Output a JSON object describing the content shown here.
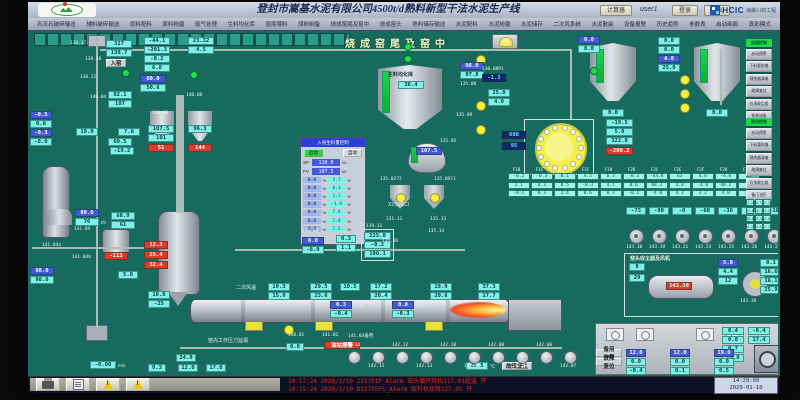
{
  "titlebar": {
    "title": "登封市嵩基水泥有限公司4500t/d熟料新型干法水泥生产线",
    "calc": "计算器",
    "user": "user1",
    "login": "登录",
    "logout": "退出",
    "logo_text": "HCIC",
    "logo_name": "海螺川崎工程"
  },
  "menu": {
    "items": [
      "石灰石破碎输送",
      "辅料破碎输送",
      "原料配料",
      "原料粉磨",
      "废气处理",
      "生料均化库",
      "窑尾喂料",
      "煤粉制备",
      "烧成窑尾及窑中",
      "烧成窑头",
      "熟料储存输送",
      "水泥配料",
      "水泥粉磨",
      "水泥储存",
      "二次风系统",
      "水泥散装",
      "设备报警",
      "历史趋势",
      "参数表",
      "启动画面",
      "真彩模式"
    ]
  },
  "screen_title": {
    "text": "烧成窑尾及窑中"
  },
  "statusbar": {
    "alarms": [
      "10:17:24 2020/1/10 231701P_Alarm 窑头循环风机117.01超温  开",
      "10:15:24 2020/1/10 B12705P1_Alarm 取料机故障127.05  开"
    ],
    "time": "14:29:09",
    "date": "2020-01-10"
  },
  "feed_panel": {
    "title": "入窑生料量控制",
    "btn_start": "启动",
    "btn_auto": "自动",
    "sp_label": "SP",
    "sp": "110.0",
    "sp_unit": "t/h",
    "pv_label": "PV",
    "pv": "107.5",
    "pv_unit": "t/h",
    "unit": "%",
    "rows": [
      {
        "a": "0.0",
        "b": "3.7"
      },
      {
        "a": "0.0",
        "b": "0.3"
      },
      {
        "a": "0.0",
        "b": "1.1"
      },
      {
        "a": "0.0",
        "b": "-1.9"
      },
      {
        "a": "0.0",
        "b": "7.6"
      },
      {
        "a": "0.0",
        "b": "2.0"
      },
      {
        "a": "0.0",
        "b": "2.5"
      }
    ]
  },
  "homo_silo": {
    "label": "生料均化库",
    "value": "36.4"
  },
  "dome_value": "107.5",
  "cooler_section": {
    "title": "窑头收尘器及风机",
    "tank_tag": "143.30"
  },
  "right_groups": [
    {
      "header": "远程控制",
      "buttons": [
        "启动预警",
        "下料管吹堵",
        "预热器清堵",
        "故障复位",
        "仓顶收尘组",
        "伴热油泵"
      ]
    },
    {
      "header": "现场控制",
      "buttons": [
        "启动预警",
        "下料管吹堵",
        "预热器清堵",
        "故障复位",
        "仓顶收尘组",
        "备用油泵"
      ]
    }
  ],
  "right_table": {
    "headers": [
      "F1",
      "F2",
      "F3"
    ],
    "rows": [
      [
        "7.2",
        "0.7",
        "2.2"
      ],
      [
        "17.8",
        "16.7",
        "4.2"
      ],
      [
        "16.0",
        "14.0",
        "4.0"
      ],
      [
        "4.2",
        "4.0",
        "1.2"
      ]
    ]
  },
  "grid_table": {
    "x": 478,
    "y": 142,
    "cw": 23,
    "headers": [
      "F1B",
      "F1C",
      "F1E",
      "F1F",
      "F1H",
      "F2B",
      "F2C",
      "F2E",
      "F2F",
      "F2H",
      "F2K"
    ],
    "rows": [
      [
        "-0.2",
        "-0.3",
        "0.1",
        "4.5",
        "6.3",
        "-0.1",
        "-44.8",
        "63",
        "4.0",
        "-4.0",
        "63"
      ],
      [
        "2.1",
        "0.3",
        "0.5",
        "-0.3",
        "4.1",
        "0.6",
        "68.3",
        "4.0",
        "-4.0",
        "40.2",
        "76"
      ],
      [
        "-0.1",
        "0.3",
        "2.4",
        "0.6",
        "0.3",
        "-0.1",
        "-4.0",
        "4.2",
        "3.2",
        "4.0",
        "1.6"
      ]
    ]
  },
  "fans": [
    {
      "v": "-73",
      "t": "143.18"
    },
    {
      "v": "-90",
      "t": "143.19"
    },
    {
      "v": "-0",
      "t": "143.21"
    },
    {
      "v": "-60",
      "t": "143.23"
    },
    {
      "v": "-36",
      "t": "143.25"
    },
    {
      "v": "-48",
      "t": "143.26"
    },
    {
      "v": "-18",
      "t": "143.28"
    }
  ],
  "motors": [
    {
      "t": "142.14",
      "p": "a"
    },
    {
      "t": "142.15",
      "p": "b"
    },
    {
      "t": "142.12",
      "p": "a"
    },
    {
      "t": "142.13",
      "p": "b"
    },
    {
      "t": "142.10",
      "p": "a"
    },
    {
      "t": "142.11",
      "p": "b"
    },
    {
      "t": "142.08",
      "p": "a"
    },
    {
      "t": "142.09",
      "p": "b"
    },
    {
      "t": "142.06",
      "p": "a"
    },
    {
      "t": "142.07",
      "p": "b"
    }
  ],
  "cabinet": {
    "btn1": "备用油泵",
    "btn2": "故障复位",
    "cols": [
      {
        "x": 596,
        "r1": "12.0",
        "r2": "0.0",
        "r3": "-0.4"
      },
      {
        "x": 640,
        "r1": "12.0",
        "r2": "0.0",
        "r3": "0.1"
      },
      {
        "x": 684,
        "r1": "19.0",
        "r2": "0.0",
        "r3": "0.5"
      }
    ]
  },
  "boxes": [
    {
      "x": 76,
      "y": 9,
      "w": 26,
      "t": "317",
      "c": "c"
    },
    {
      "x": 76,
      "y": 18,
      "w": 26,
      "t": "139.7",
      "c": "c"
    },
    {
      "x": 76,
      "y": 28,
      "w": 20,
      "t": "入窑",
      "c": "g"
    },
    {
      "x": 114,
      "y": 6,
      "w": 26,
      "t": "-44.1",
      "c": "c"
    },
    {
      "x": 114,
      "y": 15,
      "w": 26,
      "t": "-201.3",
      "c": "c"
    },
    {
      "x": 114,
      "y": 24,
      "w": 26,
      "t": "-0.2",
      "c": "c"
    },
    {
      "x": 114,
      "y": 33,
      "w": 26,
      "t": "6.8",
      "c": "c"
    },
    {
      "x": 110,
      "y": 44,
      "w": 26,
      "t": "60.0",
      "c": "b"
    },
    {
      "x": 110,
      "y": 53,
      "w": 26,
      "t": "50.6",
      "c": "c"
    },
    {
      "x": 158,
      "y": 6,
      "w": 26,
      "t": "23.32",
      "c": "c"
    },
    {
      "x": 158,
      "y": 15,
      "w": 26,
      "t": "4.5",
      "c": "c"
    },
    {
      "x": 78,
      "y": 60,
      "w": 24,
      "t": "92.1",
      "c": "c"
    },
    {
      "x": 78,
      "y": 69,
      "w": 24,
      "t": "107",
      "c": "c"
    },
    {
      "x": 118,
      "y": 94,
      "w": 26,
      "t": "107.5",
      "c": "c"
    },
    {
      "x": 118,
      "y": 103,
      "w": 26,
      "t": "101",
      "c": "c"
    },
    {
      "x": 118,
      "y": 113,
      "w": 26,
      "t": "51",
      "c": "r"
    },
    {
      "x": 158,
      "y": 94,
      "w": 24,
      "t": "96.3",
      "c": "c"
    },
    {
      "x": 158,
      "y": 113,
      "w": 24,
      "t": "144",
      "c": "r"
    },
    {
      "x": 46,
      "y": 97,
      "w": 22,
      "t": "19.9",
      "c": "c"
    },
    {
      "x": 88,
      "y": 97,
      "w": 22,
      "t": "7.6",
      "c": "c"
    },
    {
      "x": 78,
      "y": 107,
      "w": 24,
      "t": "60.5",
      "c": "c"
    },
    {
      "x": 80,
      "y": 116,
      "w": 24,
      "t": "-19.2",
      "c": "c"
    },
    {
      "x": 0,
      "y": 80,
      "w": 22,
      "t": "-0.5",
      "c": "b"
    },
    {
      "x": 0,
      "y": 89,
      "w": 22,
      "t": "0.6",
      "c": "c"
    },
    {
      "x": 0,
      "y": 98,
      "w": 22,
      "t": "-0.3",
      "c": "b"
    },
    {
      "x": 0,
      "y": 107,
      "w": 22,
      "t": "-0.0",
      "c": "c"
    },
    {
      "x": 45,
      "y": 178,
      "w": 24,
      "t": "80.0",
      "c": "b"
    },
    {
      "x": 45,
      "y": 187,
      "w": 24,
      "t": "76",
      "c": "c",
      "u": "t/h"
    },
    {
      "x": 81,
      "y": 181,
      "w": 24,
      "t": "68.9",
      "c": "c"
    },
    {
      "x": 81,
      "y": 190,
      "w": 24,
      "t": "61",
      "c": "c"
    },
    {
      "x": 74,
      "y": 221,
      "w": 24,
      "t": "-113",
      "c": "r"
    },
    {
      "x": 114,
      "y": 210,
      "w": 24,
      "t": "12.3",
      "c": "r"
    },
    {
      "x": 114,
      "y": 220,
      "w": 24,
      "t": "25.4",
      "c": "r"
    },
    {
      "x": 114,
      "y": 230,
      "w": 24,
      "t": "32.4",
      "c": "r"
    },
    {
      "x": 0,
      "y": 236,
      "w": 24,
      "t": "98.0",
      "c": "b"
    },
    {
      "x": 0,
      "y": 245,
      "w": 24,
      "t": "98.6",
      "c": "c"
    },
    {
      "x": 88,
      "y": 240,
      "w": 20,
      "t": "5.0",
      "c": "c"
    },
    {
      "x": 118,
      "y": 260,
      "w": 22,
      "t": "19.8",
      "c": "c"
    },
    {
      "x": 118,
      "y": 269,
      "w": 22,
      "t": "-25",
      "c": "c"
    },
    {
      "x": 272,
      "y": 206,
      "w": 22,
      "t": "0.0",
      "c": "b"
    },
    {
      "x": 272,
      "y": 215,
      "w": 22,
      "t": "-8.0",
      "c": "c"
    },
    {
      "x": 306,
      "y": 204,
      "w": 20,
      "t": "0.3",
      "c": "c"
    },
    {
      "x": 306,
      "y": 213,
      "w": 20,
      "t": "1.1",
      "c": "c"
    },
    {
      "x": 334,
      "y": 201,
      "w": 27,
      "t": "225.0",
      "c": "c"
    },
    {
      "x": 334,
      "y": 210,
      "w": 27,
      "t": "-0.2",
      "c": "c"
    },
    {
      "x": 334,
      "y": 219,
      "w": 27,
      "t": "100.1",
      "c": "c"
    },
    {
      "x": 238,
      "y": 252,
      "w": 22,
      "t": "19.3",
      "c": "c"
    },
    {
      "x": 238,
      "y": 261,
      "w": 22,
      "t": "15.9",
      "c": "c"
    },
    {
      "x": 280,
      "y": 252,
      "w": 22,
      "t": "29.5",
      "c": "c"
    },
    {
      "x": 280,
      "y": 261,
      "w": 22,
      "t": "23.6",
      "c": "c"
    },
    {
      "x": 310,
      "y": 252,
      "w": 20,
      "t": "10.5",
      "c": "c"
    },
    {
      "x": 340,
      "y": 252,
      "w": 22,
      "t": "17.2",
      "c": "c"
    },
    {
      "x": 340,
      "y": 261,
      "w": 22,
      "t": "20.4",
      "c": "c"
    },
    {
      "x": 400,
      "y": 252,
      "w": 22,
      "t": "19.9",
      "c": "c"
    },
    {
      "x": 400,
      "y": 261,
      "w": 22,
      "t": "20.6",
      "c": "c"
    },
    {
      "x": 448,
      "y": 252,
      "w": 22,
      "t": "37.3",
      "c": "c"
    },
    {
      "x": 448,
      "y": 261,
      "w": 22,
      "t": "17.7",
      "c": "c"
    },
    {
      "x": 300,
      "y": 270,
      "w": 22,
      "t": "0.3",
      "c": "b",
      "u": "门限"
    },
    {
      "x": 300,
      "y": 279,
      "w": 22,
      "t": "-0.4",
      "c": "c"
    },
    {
      "x": 362,
      "y": 270,
      "w": 22,
      "t": "0.8",
      "c": "b",
      "u": "门限"
    },
    {
      "x": 362,
      "y": 279,
      "w": 22,
      "t": "-0.3",
      "c": "c"
    },
    {
      "x": 256,
      "y": 312,
      "w": 18,
      "t": "0.8",
      "c": "c"
    },
    {
      "x": 294,
      "y": 310,
      "w": 36,
      "t": "油站报警",
      "c": "r"
    },
    {
      "x": 430,
      "y": 31,
      "w": 24,
      "t": "98.0",
      "c": "b"
    },
    {
      "x": 430,
      "y": 40,
      "w": 24,
      "t": "97.8",
      "c": "c"
    },
    {
      "x": 452,
      "y": 43,
      "w": 24,
      "t": "-1.3",
      "c": "n"
    },
    {
      "x": 458,
      "y": 58,
      "w": 22,
      "t": "25.0",
      "c": "c"
    },
    {
      "x": 458,
      "y": 67,
      "w": 22,
      "t": "4.0",
      "c": "c"
    },
    {
      "x": 472,
      "y": 100,
      "w": 24,
      "t": "600",
      "c": "n"
    },
    {
      "x": 472,
      "y": 111,
      "w": 24,
      "t": "95",
      "c": "n"
    },
    {
      "x": 576,
      "y": 88,
      "w": 27,
      "t": "-19.5",
      "c": "c"
    },
    {
      "x": 576,
      "y": 97,
      "w": 27,
      "t": "5.0",
      "c": "c"
    },
    {
      "x": 576,
      "y": 106,
      "w": 27,
      "t": "322.0",
      "c": "c"
    },
    {
      "x": 576,
      "y": 116,
      "w": 27,
      "t": "-290.2",
      "c": "r"
    },
    {
      "x": 548,
      "y": 5,
      "w": 22,
      "t": "0.0",
      "c": "b"
    },
    {
      "x": 548,
      "y": 14,
      "w": 22,
      "t": "0.0",
      "c": "c"
    },
    {
      "x": 628,
      "y": 6,
      "w": 22,
      "t": "0.0",
      "c": "c"
    },
    {
      "x": 628,
      "y": 15,
      "w": 22,
      "t": "0.0",
      "c": "c"
    },
    {
      "x": 628,
      "y": 24,
      "w": 22,
      "t": "4.0",
      "c": "b"
    },
    {
      "x": 628,
      "y": 33,
      "w": 22,
      "t": "25.0",
      "c": "c"
    },
    {
      "x": 572,
      "y": 78,
      "w": 22,
      "t": "0.0",
      "c": "c"
    },
    {
      "x": 676,
      "y": 78,
      "w": 22,
      "t": "0.0",
      "c": "c"
    },
    {
      "x": 599,
      "y": 232,
      "w": 16,
      "t": "0",
      "c": "c"
    },
    {
      "x": 599,
      "y": 243,
      "w": 16,
      "t": "29",
      "c": "c"
    },
    {
      "x": 688,
      "y": 228,
      "w": 20,
      "t": "5.0",
      "c": "b"
    },
    {
      "x": 688,
      "y": 237,
      "w": 20,
      "t": "4.4",
      "c": "c"
    },
    {
      "x": 688,
      "y": 246,
      "w": 20,
      "t": "12",
      "c": "c"
    },
    {
      "x": 730,
      "y": 228,
      "w": 22,
      "t": "0.1",
      "c": "c"
    },
    {
      "x": 730,
      "y": 237,
      "w": 22,
      "t": "16.6",
      "c": "c"
    },
    {
      "x": 730,
      "y": 246,
      "w": 22,
      "t": "16.1",
      "c": "c"
    },
    {
      "x": 730,
      "y": 255,
      "w": 22,
      "t": "25.9",
      "c": "c"
    },
    {
      "x": 692,
      "y": 296,
      "w": 22,
      "t": "0.4",
      "c": "c"
    },
    {
      "x": 692,
      "y": 305,
      "w": 22,
      "t": "0.0",
      "c": "c"
    },
    {
      "x": 692,
      "y": 314,
      "w": 22,
      "t": "0.7",
      "c": "c"
    },
    {
      "x": 692,
      "y": 323,
      "w": 22,
      "t": "29.0",
      "c": "c"
    },
    {
      "x": 718,
      "y": 296,
      "w": 22,
      "t": "-0.4",
      "c": "c"
    },
    {
      "x": 718,
      "y": 305,
      "w": 22,
      "t": "17.4",
      "c": "c"
    },
    {
      "x": 60,
      "y": 330,
      "w": 26,
      "t": "-0.00",
      "c": "c",
      "u": "m/s"
    },
    {
      "x": 118,
      "y": 333,
      "w": 18,
      "t": "0.3",
      "c": "c"
    },
    {
      "x": 148,
      "y": 333,
      "w": 20,
      "t": "12.0",
      "c": "c"
    },
    {
      "x": 176,
      "y": 333,
      "w": 20,
      "t": "17.0",
      "c": "c"
    },
    {
      "x": 146,
      "y": 323,
      "w": 20,
      "t": "24.0",
      "c": "c"
    },
    {
      "x": 436,
      "y": 331,
      "w": 22,
      "t": "25.5",
      "c": "c",
      "u": "℃"
    },
    {
      "x": 472,
      "y": 331,
      "w": 30,
      "t": "故障复位",
      "c": "g"
    }
  ],
  "tags": [
    {
      "x": 40,
      "y": 10,
      "t": "138.17"
    },
    {
      "x": 55,
      "y": 26,
      "t": "138.18"
    },
    {
      "x": 50,
      "y": 44,
      "t": "138.21"
    },
    {
      "x": 60,
      "y": 64,
      "t": "140.04"
    },
    {
      "x": 156,
      "y": 62,
      "t": "140.08"
    },
    {
      "x": 122,
      "y": 80,
      "t": "140.06"
    },
    {
      "x": 44,
      "y": 196,
      "t": "141.09"
    },
    {
      "x": 12,
      "y": 212,
      "t": "141.04a"
    },
    {
      "x": 42,
      "y": 224,
      "t": "141.04b"
    },
    {
      "x": 272,
      "y": 198,
      "t": "142.18"
    },
    {
      "x": 336,
      "y": 193,
      "t": "139.11"
    },
    {
      "x": 350,
      "y": 146,
      "t": "135.0272"
    },
    {
      "x": 404,
      "y": 146,
      "t": "135.0971"
    },
    {
      "x": 356,
      "y": 186,
      "t": "131.11"
    },
    {
      "x": 400,
      "y": 186,
      "t": "135.13"
    },
    {
      "x": 398,
      "y": 198,
      "t": "135.14"
    },
    {
      "x": 352,
      "y": 208,
      "t": "135.36"
    },
    {
      "x": 430,
      "y": 51,
      "t": "135.08"
    },
    {
      "x": 426,
      "y": 82,
      "t": "135.09"
    },
    {
      "x": 410,
      "y": 108,
      "t": "135.05"
    },
    {
      "x": 452,
      "y": 36,
      "t": "138.08P1"
    },
    {
      "x": 258,
      "y": 302,
      "t": "148.01"
    },
    {
      "x": 292,
      "y": 302,
      "t": "141.02"
    },
    {
      "x": 318,
      "y": 302,
      "t": "141.03备用"
    },
    {
      "x": 710,
      "y": 268,
      "t": "143.38"
    }
  ],
  "labels": [
    {
      "x": 358,
      "y": 170,
      "t": "X2沉降口"
    },
    {
      "x": 206,
      "y": 253,
      "t": "二次风温"
    },
    {
      "x": 178,
      "y": 306,
      "t": "窑内工作压力监视"
    }
  ],
  "frames": [
    {
      "x": 331,
      "y": 198,
      "w": 33,
      "h": 32
    },
    {
      "x": 494,
      "y": 88,
      "w": 70,
      "h": 56
    },
    {
      "x": 594,
      "y": 222,
      "w": 160,
      "h": 64
    }
  ],
  "greens": [
    {
      "x": 374,
      "y": 12
    },
    {
      "x": 374,
      "y": 24
    },
    {
      "x": 92,
      "y": 38
    },
    {
      "x": 560,
      "y": 36
    },
    {
      "x": 160,
      "y": 40
    }
  ],
  "yellows": [
    {
      "x": 446,
      "y": 24
    },
    {
      "x": 446,
      "y": 70
    },
    {
      "x": 446,
      "y": 94
    },
    {
      "x": 650,
      "y": 44
    },
    {
      "x": 650,
      "y": 58
    },
    {
      "x": 650,
      "y": 72
    },
    {
      "x": 366,
      "y": 162
    },
    {
      "x": 400,
      "y": 162
    },
    {
      "x": 254,
      "y": 294
    }
  ],
  "pipes": [
    {
      "x": 70,
      "y": 18,
      "w": 472,
      "h": 2
    },
    {
      "x": 540,
      "y": 18,
      "w": 2,
      "h": 70
    },
    {
      "x": 690,
      "y": 18,
      "w": 2,
      "h": 56
    },
    {
      "x": 150,
      "y": 316,
      "w": 382,
      "h": 2
    },
    {
      "x": 66,
      "y": 6,
      "w": 2,
      "h": 292
    },
    {
      "x": 146,
      "y": 64,
      "w": 8,
      "h": 118
    },
    {
      "x": 205,
      "y": 218,
      "w": 230,
      "h": 2
    },
    {
      "x": 2,
      "y": 216,
      "w": 130,
      "h": 2
    }
  ]
}
